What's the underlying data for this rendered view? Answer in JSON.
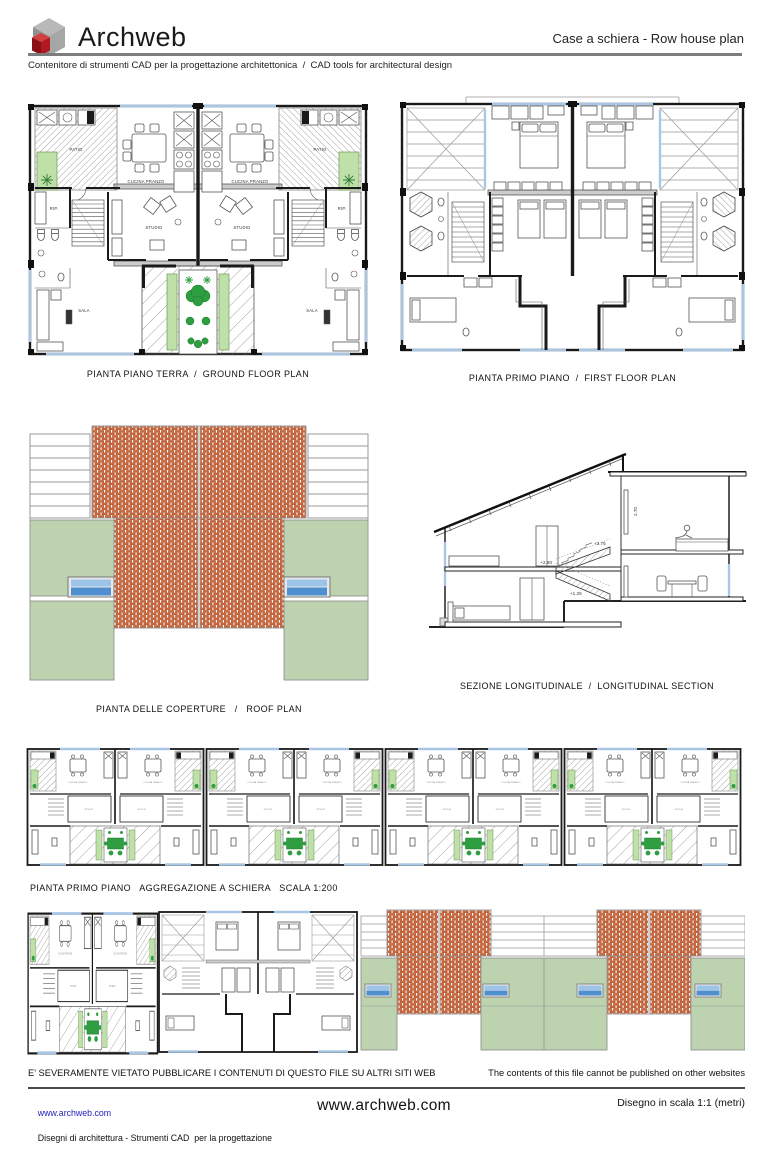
{
  "header": {
    "brand": "Archweb",
    "logo_icon": "cube-3d",
    "page_title": "Case a schiera - Row house plan",
    "subtitle": "Contenitore di strumenti CAD per la progettazione architettonica  /  CAD tools for architectural design"
  },
  "plans": {
    "ground": {
      "caption": "PIANTA PIANO TERRA  /  GROUND FLOOR PLAN",
      "labels": {
        "patio": "PATIO",
        "cucina": "CUCINA PRANZO",
        "rip": "RIP.",
        "studio": "STUDIO",
        "sala": "SALA"
      }
    },
    "first": {
      "caption": "PIANTA PRIMO PIANO  /  FIRST FLOOR PLAN"
    },
    "roof": {
      "caption": "PIANTA DELLE COPERTURE   /   ROOF PLAN"
    },
    "section": {
      "caption": "SEZIONE LONGITUDINALE  /  LONGITUDINAL SECTION",
      "levels": {
        "l1": "+2.90",
        "l2": "+3.75",
        "l3": "+1.25",
        "h": "2.70"
      }
    },
    "aggregation": {
      "caption": "PIANTA PRIMO PIANO   AGGREGAZIONE A SCHIERA   SCALA 1:200"
    }
  },
  "footer": {
    "disclaimer_it": "E' SEVERAMENTE VIETATO PUBBLICARE I CONTENUTI DI QUESTO FILE SU ALTRI SITI WEB",
    "disclaimer_en": "The contents of this file cannot be published on other websites",
    "site_link": "www.archweb.com",
    "credit_line1": "Disegni di architettura - Strumenti CAD  per la progettazione",
    "credit_line2": "Blocchi dwg - Architectural drawings",
    "credit_line3": "All rights reserved",
    "site_center": "www.archweb.com",
    "scale_note": "Disegno in scala 1:1 (metri)"
  },
  "colors": {
    "brick": "#cd6a3e",
    "roof_green": "#bdd2af",
    "skylight_dark": "#4f8fd0",
    "skylight_light": "#9cc3e8",
    "window_blue": "#a9c7e4",
    "plant_dark": "#2f9e41",
    "planter_green": "#bfe0a8",
    "wall_black": "#1a1a1a",
    "logo_red": "#b01824",
    "logo_gray": "#9c9c9c",
    "link_blue": "#2222bb"
  }
}
